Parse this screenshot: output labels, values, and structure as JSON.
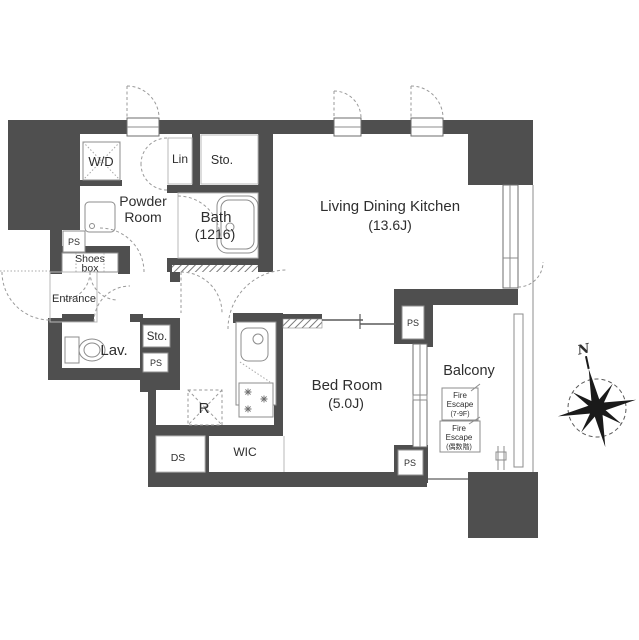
{
  "title": "apartment-floor-plan",
  "colors": {
    "wall": "#4f4f4f",
    "fixture_outline": "#8c8c8c",
    "light_line": "#b9b9b9",
    "text": "#2e2e2e"
  },
  "rooms": {
    "ldk": {
      "label": "Living Dining Kitchen",
      "size": "(13.6J)"
    },
    "bedroom": {
      "label": "Bed Room",
      "size": "(5.0J)"
    },
    "bath": {
      "label": "Bath",
      "size": "(1216)"
    },
    "powder_room": {
      "label_line1": "Powder",
      "label_line2": "Room"
    },
    "balcony": {
      "label": "Balcony"
    },
    "entrance": {
      "label": "Entrance"
    },
    "lavatory": {
      "label": "Lav."
    },
    "washer_dryer": {
      "label": "W/D"
    },
    "linen": {
      "label": "Lin"
    },
    "storage_top": {
      "label": "Sto."
    },
    "storage_hall": {
      "label": "Sto."
    },
    "walk_in_closet": {
      "label": "WIC"
    },
    "duct_space": {
      "label": "DS"
    },
    "refrigerator": {
      "label": "R"
    },
    "shoes_box": {
      "label_line1": "Shoes",
      "label_line2": "box"
    },
    "pipe_space": {
      "label": "PS"
    }
  },
  "balcony_features": {
    "fire_escape_upper": {
      "line1": "Fire",
      "line2": "Escape",
      "line3": "(7-9F)"
    },
    "fire_escape_lower": {
      "line1": "Fire",
      "line2": "Escape",
      "line3": "(偶数階)"
    }
  },
  "compass": {
    "north_label": "N"
  }
}
